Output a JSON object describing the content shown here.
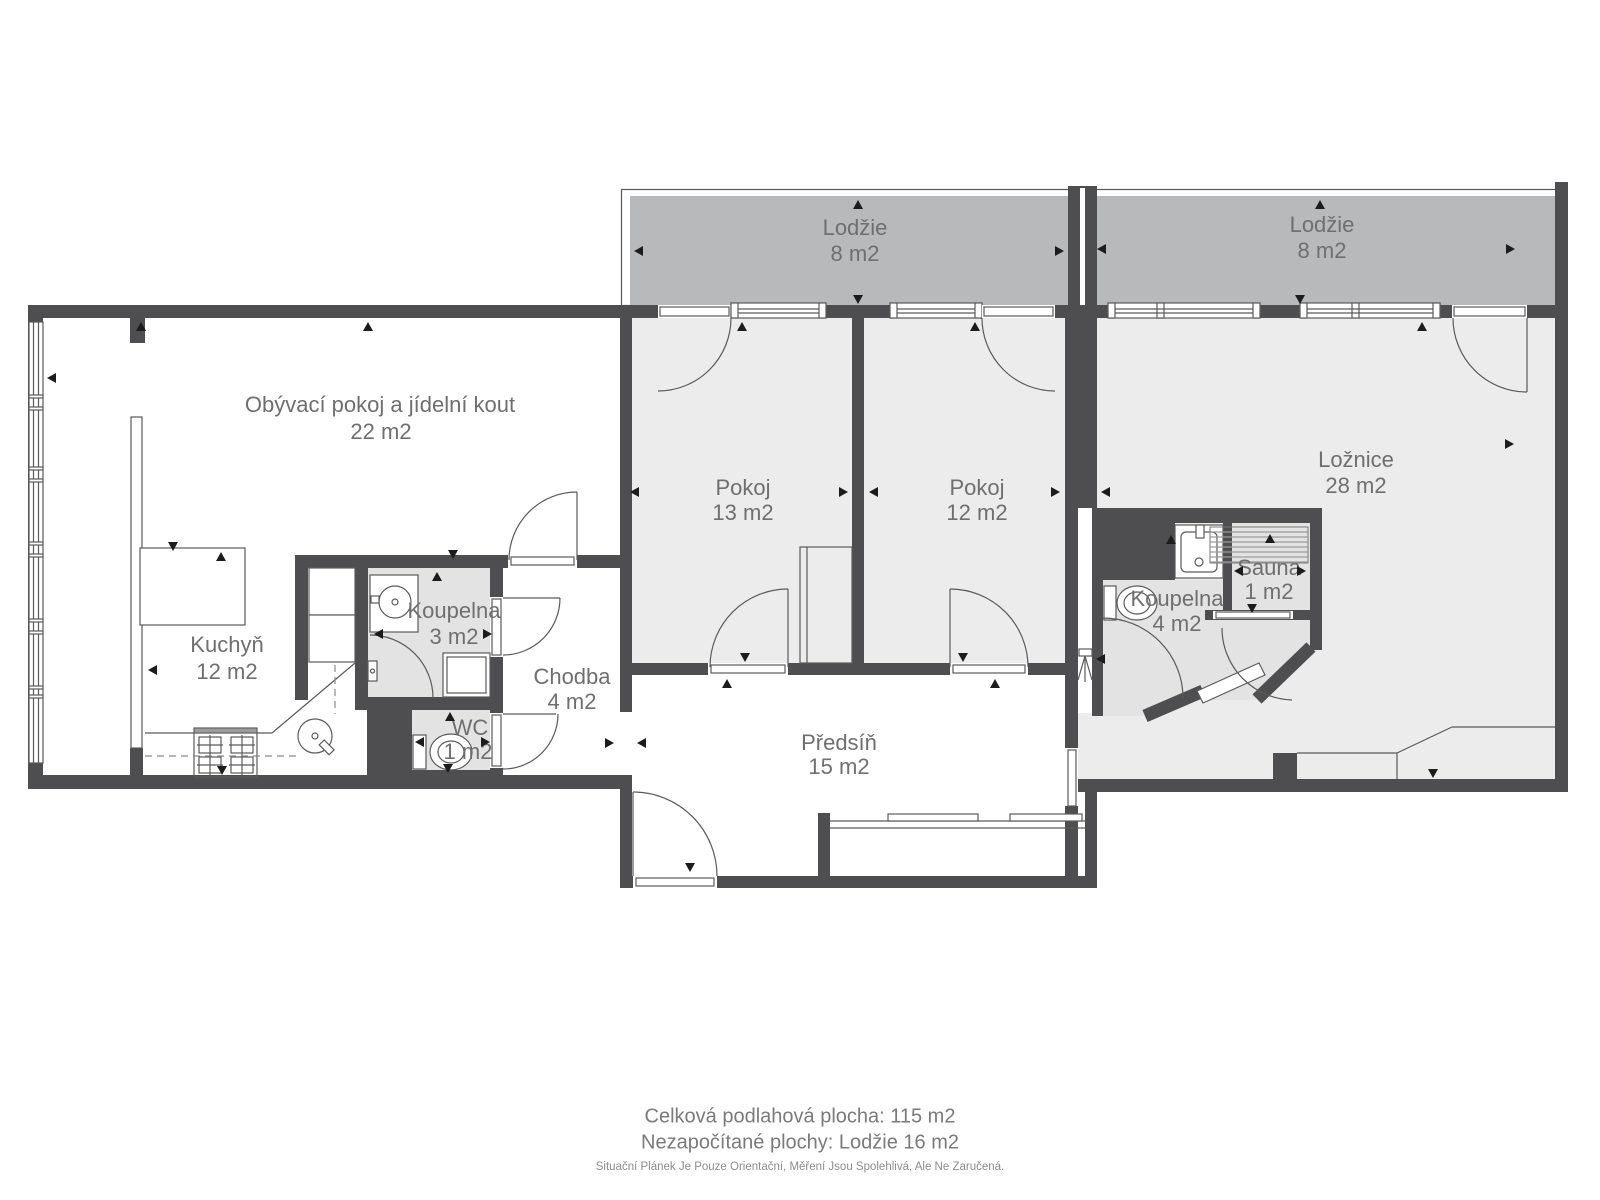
{
  "title": "Floor plan",
  "colors": {
    "wall": "#4e4e50",
    "room_fill": "#ececed",
    "wet_fill": "#e3e3e4",
    "loggia_fill": "#b8b9bb",
    "line": "#5a5a5a",
    "hatch": "#9a9a9a",
    "label": "#6f6f6f",
    "footer": "#7a7a7a",
    "disclaimer": "#8c8c8c",
    "marker": "#1c1c1c",
    "bg": "#ffffff"
  },
  "rooms": {
    "living": {
      "name": "Obývací pokoj a jídelní kout",
      "area": "22 m2"
    },
    "kitchen": {
      "name": "Kuchyň",
      "area": "12 m2"
    },
    "bathroom_small": {
      "name": "Koupelna",
      "area": "3 m2"
    },
    "wc": {
      "name": "WC",
      "area": "1 m2"
    },
    "hallway": {
      "name": "Chodba",
      "area": "4 m2"
    },
    "room1": {
      "name": "Pokoj",
      "area": "13 m2"
    },
    "room2": {
      "name": "Pokoj",
      "area": "12 m2"
    },
    "entry": {
      "name": "Předsíň",
      "area": "15 m2"
    },
    "bedroom": {
      "name": "Ložnice",
      "area": "28 m2"
    },
    "bathroom_big": {
      "name": "Koupelna",
      "area": "4 m2"
    },
    "sauna": {
      "name": "Sauna",
      "area": "1 m2"
    },
    "loggia_left": {
      "name": "Lodžie",
      "area": "8 m2"
    },
    "loggia_right": {
      "name": "Lodžie",
      "area": "8 m2"
    }
  },
  "footer": {
    "line1": "Celková podlahová plocha: 115 m2",
    "line2": "Nezapočítané plochy: Lodžie 16 m2",
    "disclaimer": "Situační Plánek Je Pouze Orientační, Měření Jsou Spolehlivá, Ale Ne Zaručená."
  },
  "markers": [
    {
      "x": 141,
      "y": 322,
      "d": "up"
    },
    {
      "x": 368,
      "y": 322,
      "d": "up"
    },
    {
      "x": 742,
      "y": 322,
      "d": "up"
    },
    {
      "x": 975,
      "y": 322,
      "d": "up"
    },
    {
      "x": 1422,
      "y": 322,
      "d": "up"
    },
    {
      "x": 858,
      "y": 200,
      "d": "up"
    },
    {
      "x": 1320,
      "y": 200,
      "d": "up"
    },
    {
      "x": 437,
      "y": 572,
      "d": "up"
    },
    {
      "x": 450,
      "y": 712,
      "d": "up"
    },
    {
      "x": 727,
      "y": 679,
      "d": "up"
    },
    {
      "x": 995,
      "y": 679,
      "d": "up"
    },
    {
      "x": 221,
      "y": 552,
      "d": "up"
    },
    {
      "x": 1171,
      "y": 535,
      "d": "up"
    },
    {
      "x": 1270,
      "y": 534,
      "d": "up"
    },
    {
      "x": 858,
      "y": 304,
      "d": "down"
    },
    {
      "x": 1300,
      "y": 304,
      "d": "down"
    },
    {
      "x": 745,
      "y": 662,
      "d": "down"
    },
    {
      "x": 963,
      "y": 662,
      "d": "down"
    },
    {
      "x": 453,
      "y": 559,
      "d": "down"
    },
    {
      "x": 448,
      "y": 773,
      "d": "down"
    },
    {
      "x": 222,
      "y": 775,
      "d": "down"
    },
    {
      "x": 690,
      "y": 872,
      "d": "down"
    },
    {
      "x": 1433,
      "y": 778,
      "d": "down"
    },
    {
      "x": 1252,
      "y": 613,
      "d": "down"
    },
    {
      "x": 173,
      "y": 551,
      "d": "down"
    },
    {
      "x": 47,
      "y": 378,
      "d": "left"
    },
    {
      "x": 634,
      "y": 251,
      "d": "left"
    },
    {
      "x": 1097,
      "y": 249,
      "d": "left"
    },
    {
      "x": 630,
      "y": 492,
      "d": "left"
    },
    {
      "x": 869,
      "y": 492,
      "d": "left"
    },
    {
      "x": 1101,
      "y": 492,
      "d": "left"
    },
    {
      "x": 374,
      "y": 634,
      "d": "left"
    },
    {
      "x": 415,
      "y": 742,
      "d": "left"
    },
    {
      "x": 148,
      "y": 670,
      "d": "left"
    },
    {
      "x": 637,
      "y": 743,
      "d": "left"
    },
    {
      "x": 1234,
      "y": 571,
      "d": "left"
    },
    {
      "x": 1096,
      "y": 659,
      "d": "left"
    },
    {
      "x": 1064,
      "y": 251,
      "d": "right"
    },
    {
      "x": 1515,
      "y": 249,
      "d": "right"
    },
    {
      "x": 848,
      "y": 492,
      "d": "right"
    },
    {
      "x": 1060,
      "y": 492,
      "d": "right"
    },
    {
      "x": 492,
      "y": 634,
      "d": "right"
    },
    {
      "x": 490,
      "y": 742,
      "d": "right"
    },
    {
      "x": 614,
      "y": 743,
      "d": "right"
    },
    {
      "x": 1306,
      "y": 571,
      "d": "right"
    },
    {
      "x": 1514,
      "y": 444,
      "d": "right"
    }
  ]
}
